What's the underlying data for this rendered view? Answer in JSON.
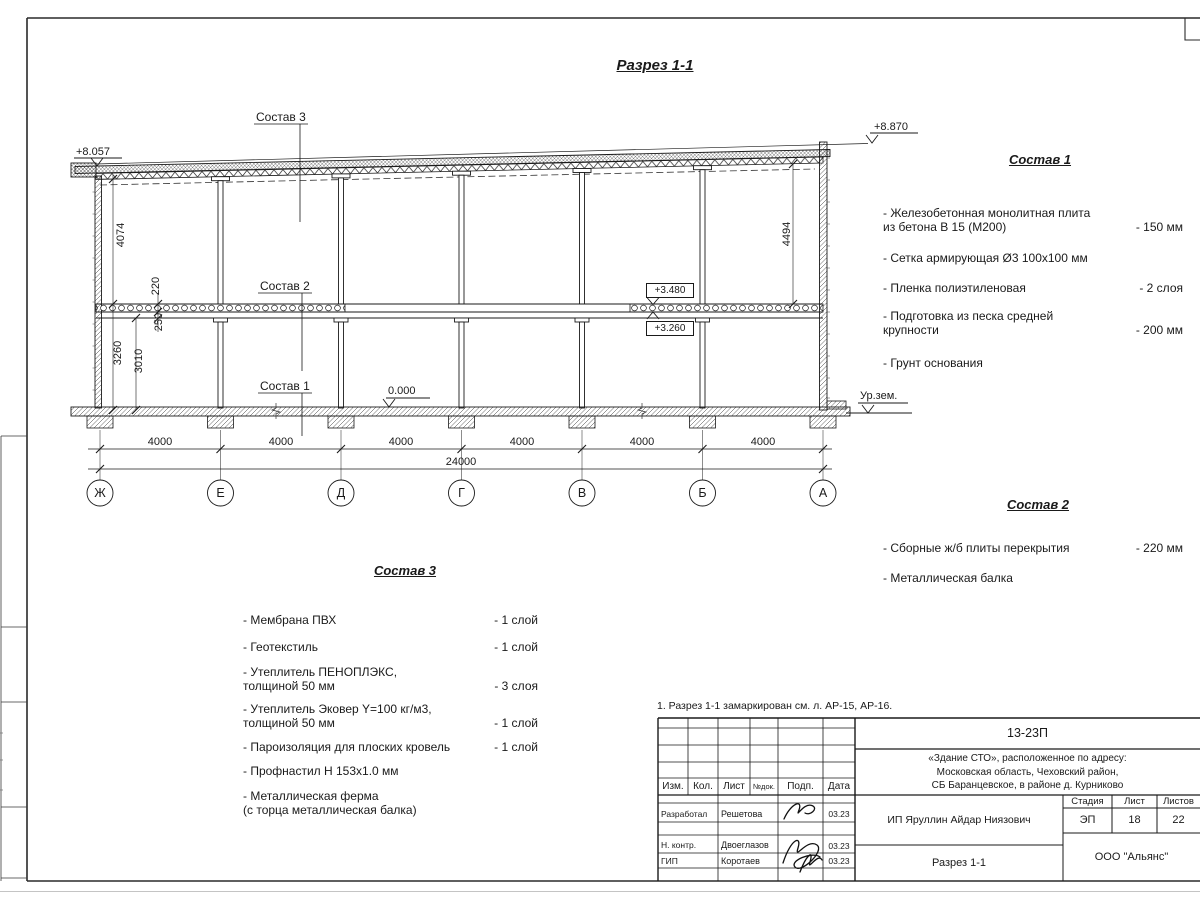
{
  "sheet": {
    "title": "Разрез 1-1",
    "note": "1. Разрез 1-1 замаркирован см. л. АР-15, АР-16."
  },
  "drawing": {
    "elevations": {
      "roof_left": "+8.057",
      "roof_right": "+8.870",
      "slab_top": "+3.480",
      "slab_bottom": "+3.260",
      "floor": "0.000",
      "ground": "Ур.зем."
    },
    "dims": {
      "v4074": "4074",
      "v220": "220",
      "v250": "250",
      "v3260": "3260",
      "v3010": "3010",
      "v4494": "4494",
      "total": "24000"
    },
    "bays": [
      "4000",
      "4000",
      "4000",
      "4000",
      "4000",
      "4000"
    ],
    "axes": [
      "Ж",
      "Е",
      "Д",
      "Г",
      "В",
      "Б",
      "А"
    ]
  },
  "sostav1": {
    "heading": "Состав 1",
    "items": [
      {
        "name": "- Железобетонная  монолитная плита\nиз бетона В 15 (М200)",
        "value": "- 150 мм"
      },
      {
        "name": "- Сетка армирующая Ø3 100х100 мм",
        "value": ""
      },
      {
        "name": "- Пленка полиэтиленовая",
        "value": "-  2 слоя"
      },
      {
        "name": "- Подготовка из песка средней\nкрупности",
        "value": "- 200 мм"
      },
      {
        "name": "- Грунт основания",
        "value": ""
      }
    ]
  },
  "sostav2": {
    "heading": "Состав 2",
    "items": [
      {
        "name": "- Сборные ж/б плиты перекрытия",
        "value": "- 220 мм"
      },
      {
        "name": "- Металлическая  балка",
        "value": ""
      }
    ]
  },
  "sostav3": {
    "heading": "Состав 3",
    "items": [
      {
        "name": "- Мембрана ПВХ",
        "value": "- 1 слой"
      },
      {
        "name": "- Геотекстиль",
        "value": "- 1 слой"
      },
      {
        "name": "- Утеплитель ПЕНОПЛЭКС,\nтолщиной 50 мм",
        "value": "- 3 слоя"
      },
      {
        "name": "- Утеплитель Эковер Y=100 кг/м3,\nтолщиной 50 мм",
        "value": "- 1 слой"
      },
      {
        "name": "- Пароизоляция для плоских кровель",
        "value": "- 1 слой"
      },
      {
        "name": "- Профнастил Н 153х1.0 мм",
        "value": ""
      },
      {
        "name": "- Металлическая ферма\n(с торца металлическая балка)",
        "value": ""
      }
    ]
  },
  "titleblock": {
    "doc_number": "13-23П",
    "object": "«Здание СТО», расположенное по адресу:\nМосковская область, Чеховский район,\nСБ Баранцевское, в районе д. Курниково",
    "customer": "ИП Яруллин Айдар Ниязович",
    "section_name": "Разрез 1-1",
    "company": "ООО \"Альянс\"",
    "stage_label": "Стадия",
    "sheet_label": "Лист",
    "sheets_label": "Листов",
    "stage": "ЭП",
    "sheet_no": "18",
    "sheets_total": "22",
    "cols": {
      "izm": "Изм.",
      "kol": "Кол.",
      "list": "Лист",
      "ndok": "№док.",
      "podp": "Подп.",
      "data": "Дата"
    },
    "rows": [
      {
        "role": "Разработал",
        "name": "Решетова",
        "date": "03.23"
      },
      {
        "role": "Н. контр.",
        "name": "Двоеглазов",
        "date": "03.23"
      },
      {
        "role": "ГИП",
        "name": "Коротаев",
        "date": "03.23"
      }
    ]
  }
}
